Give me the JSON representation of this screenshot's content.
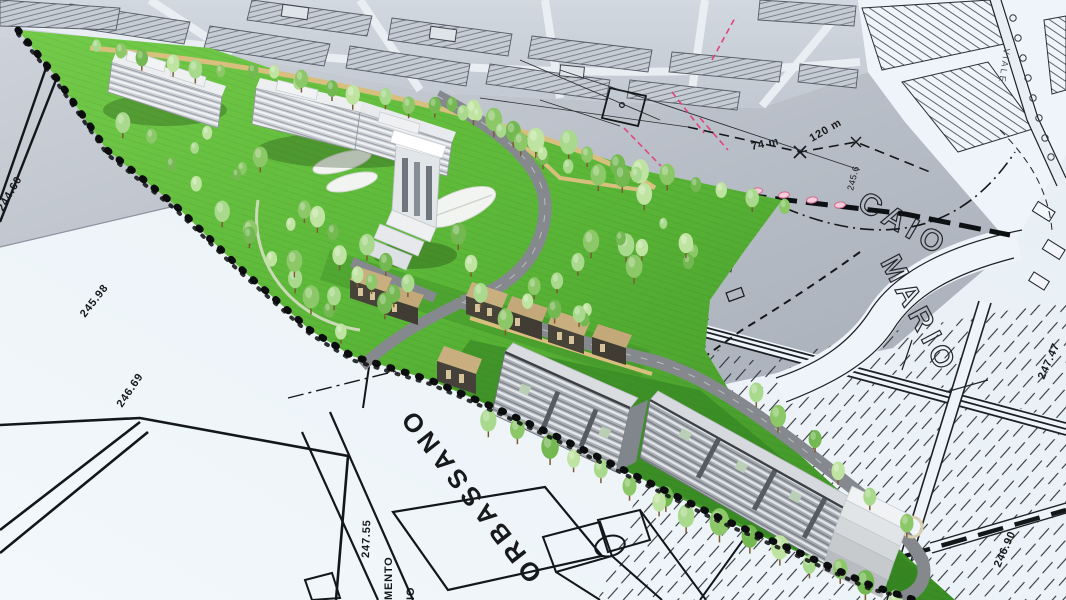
{
  "scene": {
    "description": "Aerial 3D masterplan rendering of a green residential development superimposed on a black-and-white cadastral site plan"
  },
  "street_labels": {
    "orbassano": "ORBASSANO",
    "viale": "VIALE",
    "outline_caio": "CAIO",
    "outline_mario": "MARIO"
  },
  "partial_words": {
    "word1": "MENTO",
    "word2": "IO"
  },
  "elevation_labels": {
    "e244_60": "244.60",
    "e245_98": "245.98",
    "e246_69": "246.69",
    "e247_55": "247.55",
    "e246_90": "246.90",
    "e247_47": "247.47",
    "e247_4": "247.4",
    "e245_6": "245.6"
  },
  "measurement_labels": {
    "m74": "74 m",
    "m120": "120 m"
  },
  "colors": {
    "lawn": "#5cb83a",
    "ink": "#17191b",
    "paper": "#eef4f9",
    "plan": "#b9bfc8",
    "pink": "#e0457b",
    "tan": "#d9bf7d",
    "bldg": "#e9ebee",
    "roofTan": "#c8ad7f"
  }
}
